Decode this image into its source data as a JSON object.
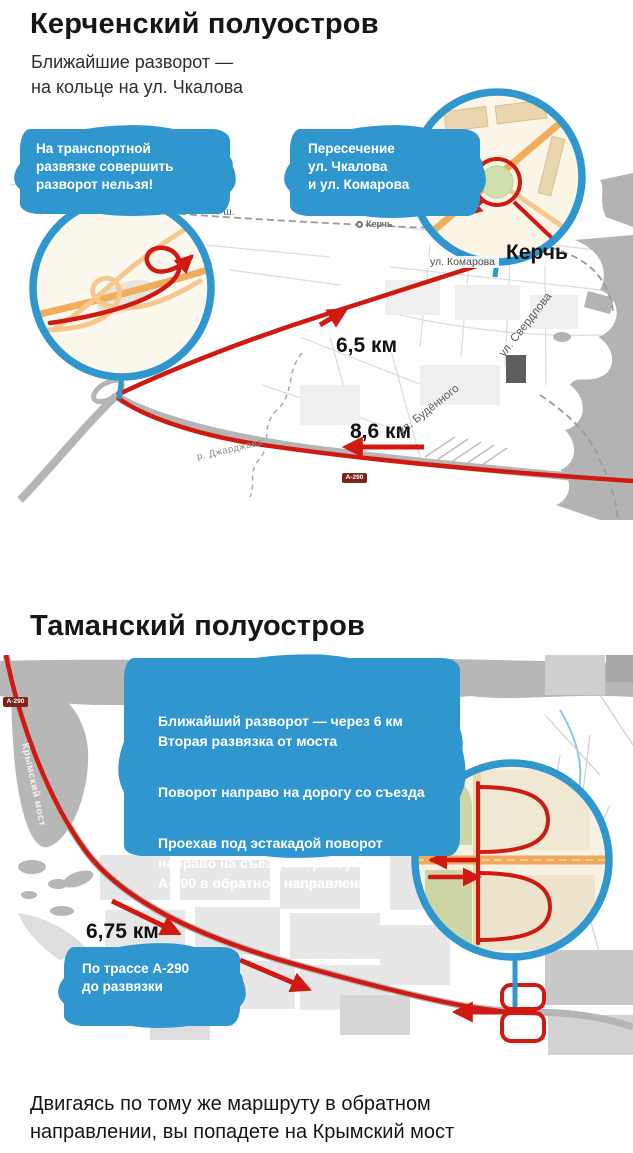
{
  "colors": {
    "accent_blue": "#2f97ce",
    "route_red": "#d01910",
    "highway_orange": "#f0ad5c",
    "water_gray": "#b3b3b3",
    "water_blue": "#3e9ccf"
  },
  "kerch": {
    "title": "Керченский полуостров",
    "subtitle": "Ближайшие разворот —\nна кольце на ул. Чкалова",
    "callout_no_uturn": "На транспортной\nразвязке совершить\nразворот нельзя!",
    "callout_intersection": "Пересечение\nул. Чкалова\nи ул. Комарова",
    "distance_forward": "6,5 км",
    "distance_back": "8,6 км",
    "city": "Керчь",
    "station": "Керчь",
    "street_komarova": "ул. Комарова",
    "street_sverdlova": "ул. Свердлова",
    "street_budennogo": "ул. Будённого",
    "street_vokzalnoe": "зальное ш.",
    "river": "р. Джарджава",
    "road_badge": "А-290"
  },
  "taman": {
    "title": "Таманский полуостров",
    "info_para1": "Ближайший разворот — через 6 км\nВторая развязка от моста",
    "info_para2": "Поворот направо на дорогу со съезда",
    "info_para3": "Проехав под эстакадой поворот\nнаправо на съезд на трассу\nА-290 в обратном направлении",
    "distance": "6,75 км",
    "callout_route": "По трассе А-290\nдо развязки",
    "bridge": "Крымский мост",
    "road_badge": "А-290"
  },
  "footer": "Двигаясь по тому же маршруту в обратном\nнаправлении, вы попадете на Крымский мост"
}
